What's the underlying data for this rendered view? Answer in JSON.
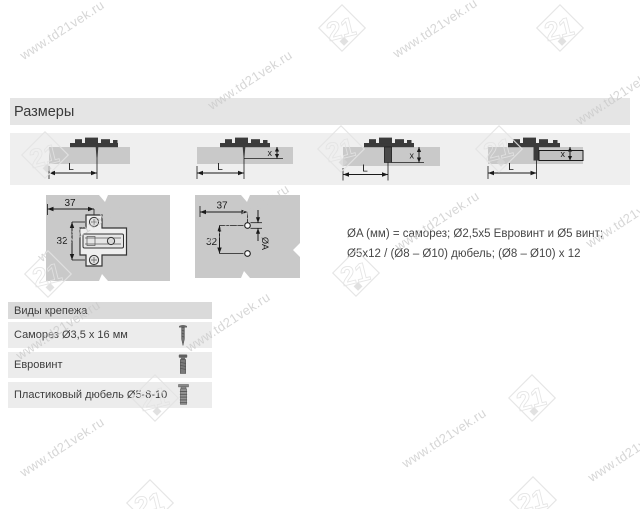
{
  "header": {
    "title": "Размеры"
  },
  "side_views": [
    {
      "length_label": "L"
    },
    {
      "length_label": "L",
      "depth_label": "x"
    },
    {
      "length_label": "L",
      "depth_label": "x"
    },
    {
      "length_label": "L",
      "depth_label": "x"
    }
  ],
  "plan_views": {
    "plate_top_view": {
      "width_dim": "37",
      "height_dim": "32"
    },
    "drill_pattern": {
      "width_dim": "37",
      "height_dim": "32",
      "hole_diameter_label": "ØA"
    }
  },
  "note": {
    "line1": "ØA (мм) = саморез; Ø2,5x5 Евровинт и Ø5 винт;",
    "line2": "Ø5x12 / (Ø8 – Ø10) дюбель; (Ø8 – Ø10) x 12"
  },
  "fasteners_table": {
    "title": "Виды крепежа",
    "rows": [
      {
        "label": "Саморез Ø3,5 x 16 мм",
        "icon": "wood-screw-icon"
      },
      {
        "label": "Евровинт",
        "icon": "euro-screw-icon"
      },
      {
        "label": "Пластиковый дюбель Ø5-8-10",
        "icon": "plastic-dowel-icon"
      }
    ]
  },
  "watermark": {
    "url_text": "www.td21vek.ru",
    "logo_text": "21",
    "text_positions": [
      [
        62,
        30
      ],
      [
        250,
        80
      ],
      [
        435,
        28
      ],
      [
        618,
        95
      ],
      [
        80,
        232
      ],
      [
        247,
        214
      ],
      [
        437,
        221
      ],
      [
        628,
        218
      ],
      [
        58,
        330
      ],
      [
        228,
        322
      ],
      [
        62,
        447
      ],
      [
        444,
        438
      ],
      [
        630,
        452
      ]
    ],
    "logo_positions": [
      [
        342,
        28
      ],
      [
        560,
        28
      ],
      [
        45,
        155
      ],
      [
        341,
        149
      ],
      [
        499,
        149
      ],
      [
        48,
        274
      ],
      [
        356,
        273
      ],
      [
        155,
        398
      ],
      [
        532,
        398
      ],
      [
        150,
        503
      ],
      [
        533,
        500
      ]
    ]
  },
  "colors": {
    "panel_gray": "#c9c9c9",
    "header_band_gray": "#e5e5e5",
    "drawings_band_gray": "#efefef",
    "table_header_gray": "#dadada",
    "table_row_gray": "#ececec",
    "hardware_dark": "#3b3b3b",
    "watermark_gray": "#c9c9c9"
  }
}
